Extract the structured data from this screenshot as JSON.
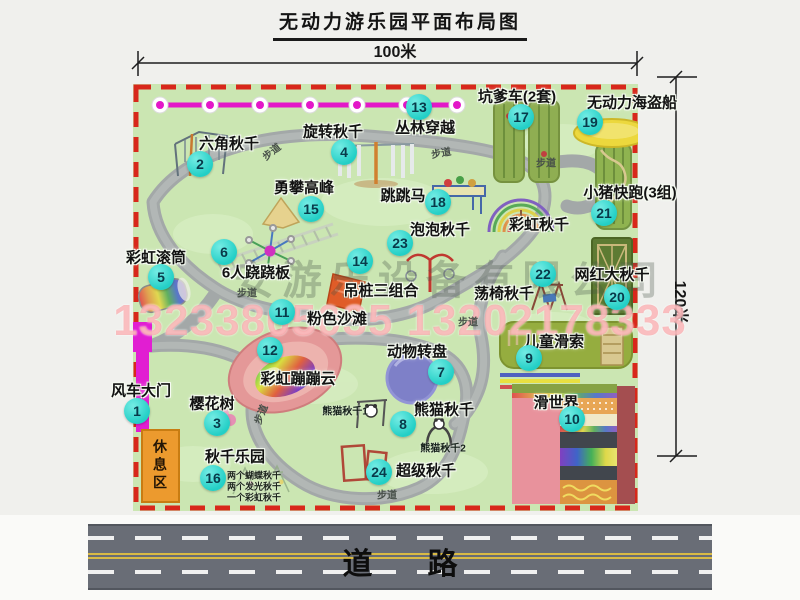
{
  "title": "无动力游乐园平面布局图",
  "dimensions": {
    "top": "100米",
    "right": "120米"
  },
  "road": {
    "label": "道路"
  },
  "watermark": {
    "company": "安游乐设备有限公司",
    "phone": "13233805035 13202178333"
  },
  "colors": {
    "map_green": "#cbe6b2",
    "border_red": "#d8271b",
    "badge_teal": "#23cfc6",
    "zipline_magenta": "#e318c8",
    "gate_magenta": "#e11ed2",
    "path_gray": "#a6abab",
    "road_gray": "#696d76",
    "rest_orange": "#ec9a2e"
  },
  "map": {
    "attractions": [
      {
        "num": "1",
        "name": "风车大门",
        "lx": 141,
        "ly": 390,
        "bx": 137,
        "by": 411
      },
      {
        "num": "2",
        "name": "六角秋千",
        "lx": 229,
        "ly": 143,
        "bx": 200,
        "by": 164
      },
      {
        "num": "3",
        "name": "樱花树",
        "lx": 212,
        "ly": 403,
        "bx": 217,
        "by": 423
      },
      {
        "num": "4",
        "name": "旋转秋千",
        "lx": 333,
        "ly": 131,
        "bx": 344,
        "by": 152
      },
      {
        "num": "5",
        "name": "彩虹滚筒",
        "lx": 156,
        "ly": 257,
        "bx": 161,
        "by": 277
      },
      {
        "num": "6",
        "name": "6人跷跷板",
        "lx": 256,
        "ly": 272,
        "bx": 224,
        "by": 252
      },
      {
        "num": "7",
        "name": "动物转盘",
        "lx": 417,
        "ly": 351,
        "bx": 441,
        "by": 372
      },
      {
        "num": "8",
        "name": "熊猫秋千",
        "lx": 444,
        "ly": 409,
        "bx": 403,
        "by": 424
      },
      {
        "num": "9",
        "name": "儿童滑索",
        "lx": 554,
        "ly": 341,
        "bx": 529,
        "by": 358
      },
      {
        "num": "10",
        "name": "滑世界",
        "lx": 556,
        "ly": 402,
        "bx": 572,
        "by": 419
      },
      {
        "num": "11",
        "name": "粉色沙滩",
        "lx": 337,
        "ly": 318,
        "bx": 282,
        "by": 312
      },
      {
        "num": "12",
        "name": "彩虹蹦蹦云",
        "lx": 298,
        "ly": 378,
        "bx": 270,
        "by": 350
      },
      {
        "num": "13",
        "name": "丛林穿越",
        "lx": 425,
        "ly": 127,
        "bx": 419,
        "by": 107
      },
      {
        "num": "14",
        "name": "吊桩三组合",
        "lx": 381,
        "ly": 290,
        "bx": 360,
        "by": 261
      },
      {
        "num": "15",
        "name": "勇攀高峰",
        "lx": 304,
        "ly": 187,
        "bx": 311,
        "by": 209
      },
      {
        "num": "16",
        "name": "秋千乐园",
        "lx": 235,
        "ly": 456,
        "bx": 213,
        "by": 478
      },
      {
        "num": "17",
        "name": "坑爹车(2套)",
        "lx": 517,
        "ly": 96,
        "bx": 521,
        "by": 117
      },
      {
        "num": "18",
        "name": "跳跳马",
        "lx": 403,
        "ly": 195,
        "bx": 438,
        "by": 202
      },
      {
        "num": "19",
        "name": "无动力海盗船",
        "lx": 632,
        "ly": 102,
        "bx": 590,
        "by": 122
      },
      {
        "num": "20",
        "name": "网红大秋千",
        "lx": 612,
        "ly": 274,
        "bx": 617,
        "by": 297
      },
      {
        "num": "21",
        "name": "小猪快跑(3组)",
        "lx": 630,
        "ly": 192,
        "bx": 604,
        "by": 213
      },
      {
        "num": "22",
        "name": "荡椅秋千",
        "lx": 504,
        "ly": 293,
        "bx": 543,
        "by": 274
      },
      {
        "num": "23",
        "name": "泡泡秋千",
        "lx": 440,
        "ly": 229,
        "bx": 400,
        "by": 243
      },
      {
        "num": "24",
        "name": "超级秋千",
        "lx": 426,
        "ly": 470,
        "bx": 379,
        "by": 472
      },
      {
        "name": "彩虹秋千",
        "lx": 539,
        "ly": 224
      }
    ],
    "small_labels": [
      {
        "text": "熊猫秋千1",
        "x": 345,
        "y": 410
      },
      {
        "text": "熊猫秋千2",
        "x": 443,
        "y": 447
      }
    ],
    "rest_area": {
      "label": "休息区",
      "x": 160,
      "y": 466
    },
    "notes": [
      {
        "text": "两个蝴蝶秋千",
        "x": 227,
        "y": 475
      },
      {
        "text": "两个发光秋千",
        "x": 227,
        "y": 486
      },
      {
        "text": "一个彩虹秋千",
        "x": 227,
        "y": 497
      }
    ],
    "path_labels": [
      {
        "text": "步道",
        "x": 271,
        "y": 151,
        "rot": -38
      },
      {
        "text": "步道",
        "x": 441,
        "y": 152,
        "rot": -10
      },
      {
        "text": "步道",
        "x": 546,
        "y": 162,
        "rot": 0
      },
      {
        "text": "步道",
        "x": 247,
        "y": 292,
        "rot": 0
      },
      {
        "text": "步道",
        "x": 468,
        "y": 321,
        "rot": 0
      },
      {
        "text": "步道",
        "x": 260,
        "y": 414,
        "rot": -68
      },
      {
        "text": "步道",
        "x": 387,
        "y": 494,
        "rot": 0
      }
    ]
  }
}
